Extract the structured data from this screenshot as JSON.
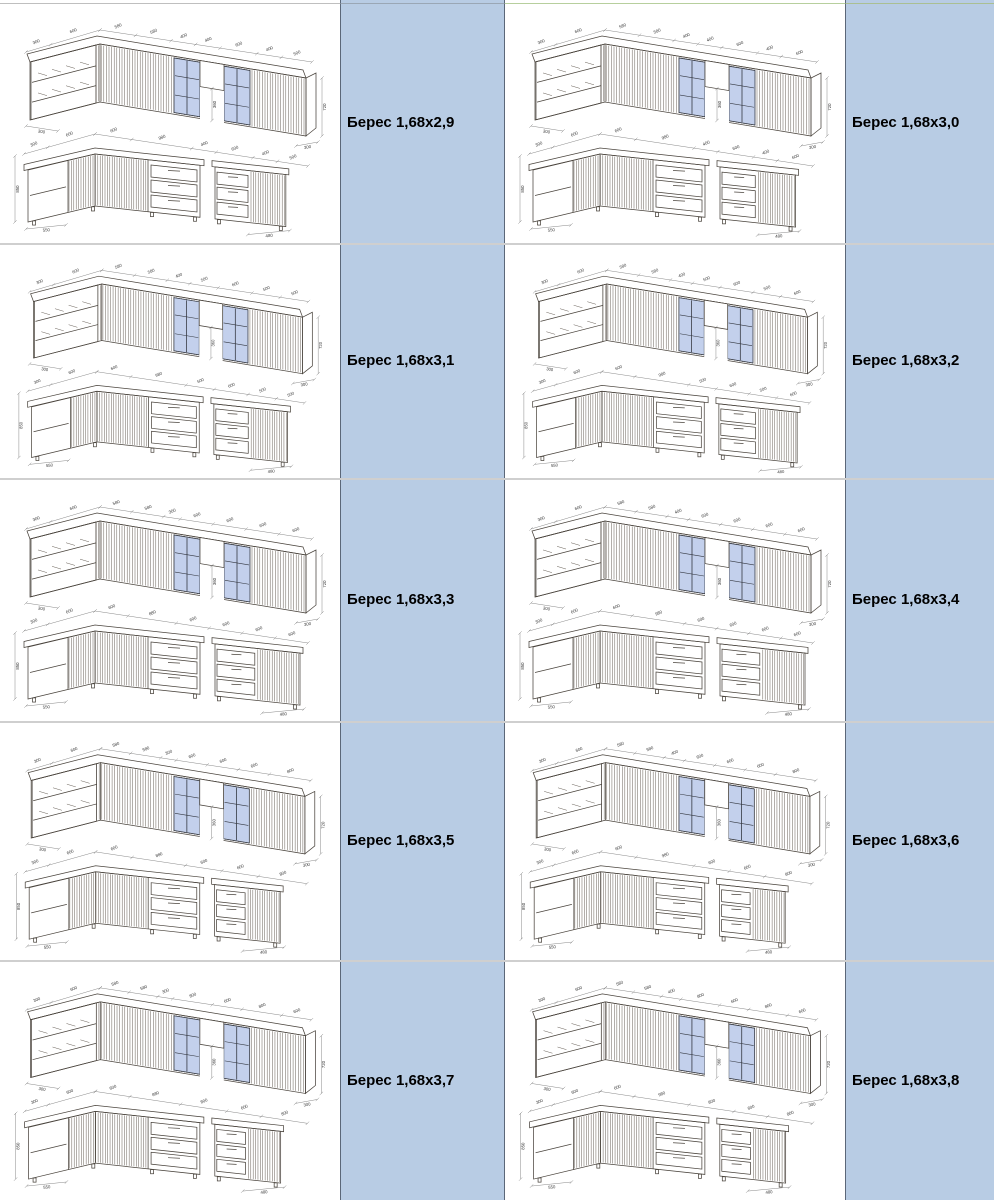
{
  "catalog": {
    "items": [
      {
        "model": "Берес 1,68x2,9",
        "upper_dims": [
          "300",
          "600",
          "580",
          "580",
          "400",
          "400",
          "600",
          "400",
          "500"
        ],
        "lower_dims_main": [
          "300",
          "600",
          "600",
          "980",
          "400"
        ],
        "lower_dims_island": [
          "600",
          "400",
          "500"
        ]
      },
      {
        "model": "Берес 1,68x3,0",
        "upper_dims": [
          "300",
          "600",
          "580",
          "580",
          "400",
          "400",
          "600",
          "400",
          "600"
        ],
        "lower_dims_main": [
          "300",
          "600",
          "600",
          "980",
          "400"
        ],
        "lower_dims_island": [
          "600",
          "400",
          "600"
        ]
      },
      {
        "model": "Берес 1,68x3,1",
        "upper_dims": [
          "300",
          "600",
          "580",
          "580",
          "400",
          "500",
          "600",
          "500",
          "500"
        ],
        "lower_dims_main": [
          "300",
          "600",
          "600",
          "980",
          "500"
        ],
        "lower_dims_island": [
          "600",
          "500",
          "500"
        ]
      },
      {
        "model": "Берес 1,68x3,2",
        "upper_dims": [
          "300",
          "600",
          "580",
          "580",
          "400",
          "500",
          "600",
          "500",
          "600"
        ],
        "lower_dims_main": [
          "300",
          "600",
          "600",
          "980",
          "500"
        ],
        "lower_dims_island": [
          "600",
          "500",
          "600"
        ]
      },
      {
        "model": "Берес 1,68x3,3",
        "upper_dims": [
          "300",
          "600",
          "580",
          "580",
          "300",
          "600",
          "600",
          "600",
          "600"
        ],
        "lower_dims_main": [
          "300",
          "600",
          "600",
          "880",
          "600"
        ],
        "lower_dims_island": [
          "600",
          "600",
          "600"
        ]
      },
      {
        "model": "Берес 1,68x3,4",
        "upper_dims": [
          "300",
          "600",
          "580",
          "580",
          "400",
          "600",
          "600",
          "600",
          "600"
        ],
        "lower_dims_main": [
          "300",
          "600",
          "600",
          "980",
          "600"
        ],
        "lower_dims_island": [
          "600",
          "600",
          "600"
        ]
      },
      {
        "model": "Берес 1,68x3,5",
        "upper_dims": [
          "300",
          "600",
          "580",
          "580",
          "300",
          "600",
          "600",
          "600",
          "800"
        ],
        "lower_dims_main": [
          "300",
          "600",
          "600",
          "880",
          "600"
        ],
        "lower_dims_island": [
          "600",
          "800"
        ]
      },
      {
        "model": "Берес 1,68x3,6",
        "upper_dims": [
          "300",
          "600",
          "580",
          "580",
          "400",
          "600",
          "600",
          "600",
          "800"
        ],
        "lower_dims_main": [
          "300",
          "600",
          "600",
          "980",
          "600"
        ],
        "lower_dims_island": [
          "600",
          "800"
        ]
      },
      {
        "model": "Берес 1,68x3,7",
        "upper_dims": [
          "300",
          "600",
          "580",
          "580",
          "300",
          "800",
          "600",
          "800",
          "600"
        ],
        "lower_dims_main": [
          "300",
          "600",
          "600",
          "880",
          "800"
        ],
        "lower_dims_island": [
          "600",
          "800"
        ]
      },
      {
        "model": "Берес 1,68x3,8",
        "upper_dims": [
          "300",
          "600",
          "580",
          "580",
          "400",
          "800",
          "600",
          "800",
          "600"
        ],
        "lower_dims_main": [
          "300",
          "600",
          "600",
          "980",
          "800"
        ],
        "lower_dims_island": [
          "600",
          "800"
        ]
      }
    ],
    "common_dims": {
      "upper_height": "720",
      "upper_gap_height": "360",
      "upper_depth": "300",
      "upper_end_depth": "300",
      "base_height": "850",
      "base_depth_left": "550",
      "base_depth_right": "480"
    },
    "colors": {
      "label_cell_bg": "#b8cce4",
      "label_cell_border": "#5b6778",
      "grid_line": "#cfcfcf",
      "green_line": "#b7cf9d",
      "cabinet_fill": "#f4e7d6",
      "cabinet_top": "#faf3e8",
      "cabinet_side": "#ead9c3",
      "glass_fill": "#c3d0ec",
      "outline": "#4a443d",
      "dim_line": "#7a7a7a"
    },
    "layout": {
      "rows": 5,
      "cols": 2
    }
  }
}
